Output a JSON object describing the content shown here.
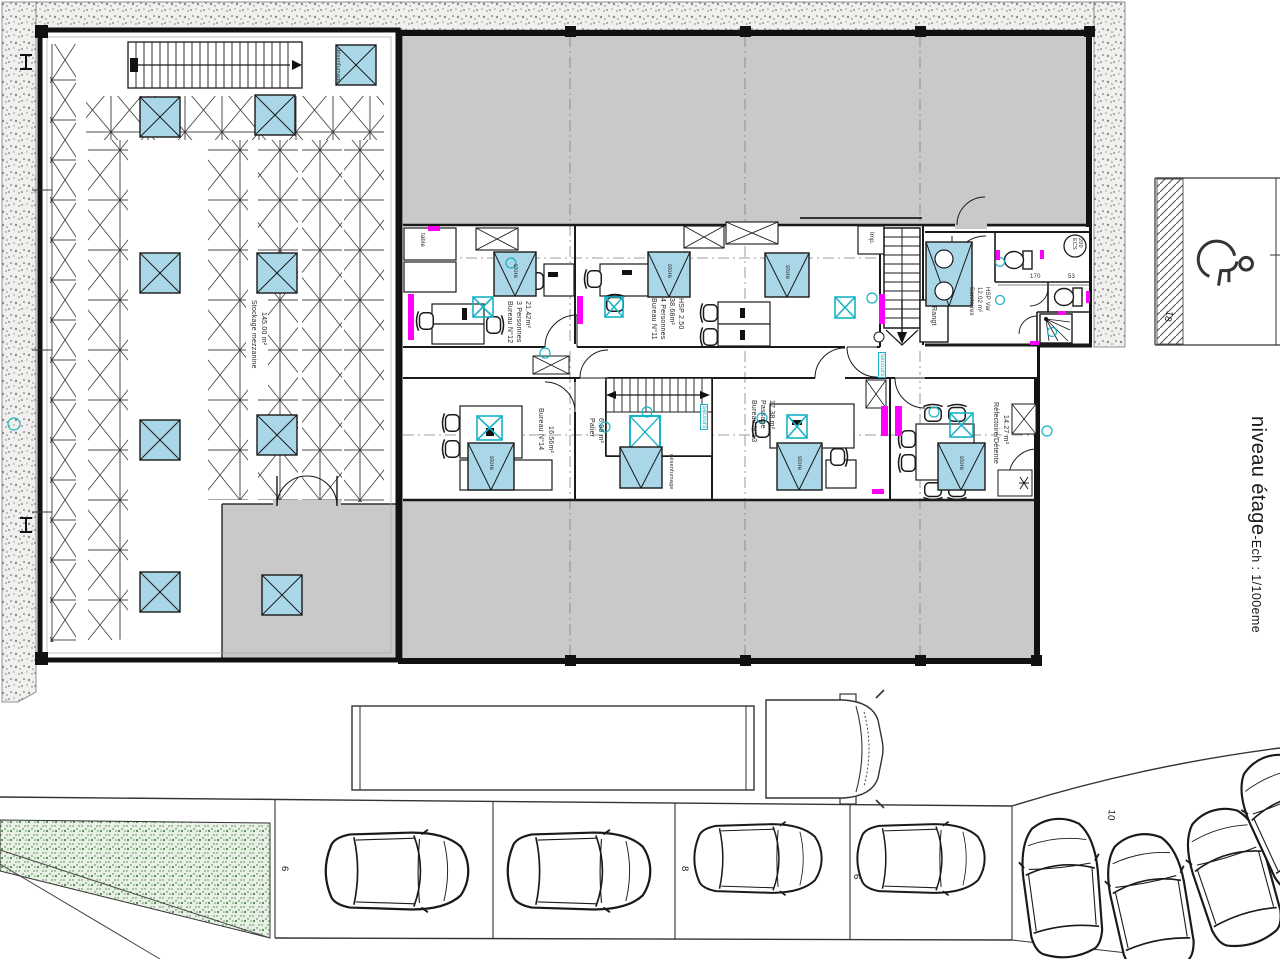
{
  "title": {
    "main": "niveau étage",
    "suffix": "-Ech : 1/100eme"
  },
  "warehouse": {
    "label": "Stockage mezzanine",
    "area": "145.00 m²"
  },
  "rooms": {
    "bureau12": {
      "name": "Bureau N°12",
      "capacity": "3 Personnes",
      "area": "21.42m²"
    },
    "bureau11": {
      "name": "Bureau N°11",
      "capacity": "4 Personnes",
      "area": "38.68m²",
      "height": "HSP 2.50"
    },
    "bureau14": {
      "name": "Bureau N°14",
      "area": "16.56m²"
    },
    "palier": {
      "name": "Palier",
      "area": "6.96 m²"
    },
    "bureau13": {
      "name": "Bureau N°13",
      "subtitle": "Passage",
      "area": "17.38 m²"
    },
    "refectoire": {
      "name": "Réfectoire/Détente",
      "area": "14.27 m²"
    },
    "sanitaires": {
      "name": "Sanitaires",
      "area": "12.02 m²",
      "height": "HSP Var"
    },
    "rangt": {
      "name": "Rangt"
    }
  },
  "equipment": {
    "printer": "Imp.",
    "table": "table",
    "blind": "store",
    "smoke_vent": "désenfumage",
    "emergency": "secours",
    "water_heater_line1": "ECS",
    "water_heater_line2": "200"
  },
  "dimensions": {
    "d1": "170",
    "d2": "53"
  },
  "parking": {
    "row_counts": [
      "6",
      "8",
      "6"
    ],
    "right_count": "10",
    "disabled_count": "18"
  },
  "colors": {
    "skylight_blue": "#a9d7e8",
    "accent_cyan": "#17b3c6",
    "radiator_magenta": "#ff00ff",
    "roof_gray": "#c9c9c9",
    "landscape_green": "#4a8a46"
  }
}
